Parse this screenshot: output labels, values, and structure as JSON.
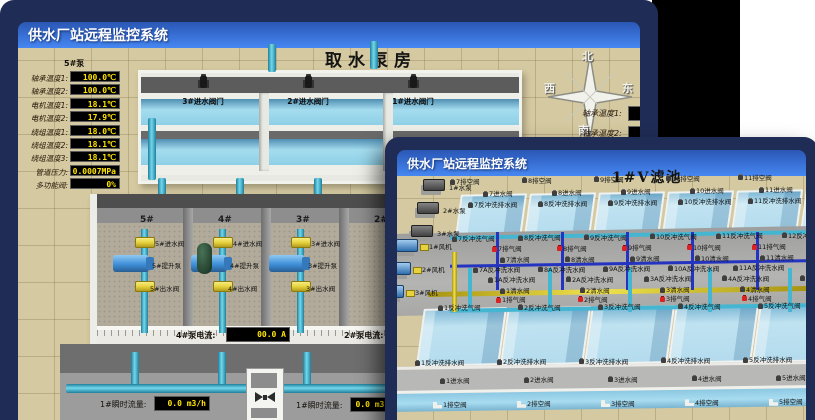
{
  "colors": {
    "frame": "#1f2c55",
    "titlebar_top": "#2a57b5",
    "titlebar_bottom": "#4687f2",
    "floor_tan": "#d4c9a0",
    "led_text": "#ffe400",
    "pipe_cyan": "#45b6d2",
    "valve_yellow": "#e6d23e",
    "pump_blue": "#3f8fd9",
    "water_blue": "#bfe2f0",
    "alarm_red": "#d92222",
    "patch_black": "#000000"
  },
  "back_window": {
    "title": "供水厂站远程监控系统",
    "scene_title": "取水泵房",
    "compass": {
      "n": "北",
      "w": "西",
      "s": "南",
      "e": "东"
    },
    "left_panel": {
      "header": "5#泵",
      "rows": [
        {
          "label": "轴承温度1:",
          "value": "100.0℃"
        },
        {
          "label": "轴承温度2:",
          "value": "100.0℃"
        },
        {
          "label": "电机温度1:",
          "value": "18.1℃"
        },
        {
          "label": "电机温度2:",
          "value": "17.9℃"
        },
        {
          "label": "绕组温度1:",
          "value": "18.0℃"
        },
        {
          "label": "绕组温度2:",
          "value": "18.1℃"
        },
        {
          "label": "绕组温度3:",
          "value": "18.1℃"
        },
        {
          "label": "管道压力:",
          "value": "0.0007MPa"
        },
        {
          "label": "多功能阀:",
          "value": "0%"
        }
      ]
    },
    "right_panel": {
      "rows": [
        "轴承温度1:",
        "轴承温度2:"
      ]
    },
    "intake_valves": [
      "3#进水阀门",
      "2#进水阀门",
      "1#进水阀门"
    ],
    "bay_numbers": [
      "5#",
      "4#",
      "3#",
      "2#"
    ],
    "bays": [
      {
        "inlet": "5#进水阀",
        "pump": "5#提升泵",
        "outlet": "5#出水阀"
      },
      {
        "inlet": "4#进水阀",
        "pump": "4#提升泵",
        "outlet": "4#出水阀"
      },
      {
        "inlet": "3#进水阀",
        "pump": "3#提升泵",
        "outlet": "3#出水阀"
      }
    ],
    "current_left": {
      "label": "4#泵电流:",
      "value": "00.0 A"
    },
    "current_right": {
      "label": "2#泵电流:",
      "value": "00.0 A"
    },
    "flow_left": {
      "label": "1#瞬时流量:",
      "value": "0.0 m3/h"
    },
    "flow_right": {
      "label": "1#瞬时流量:",
      "value": "0.0 m3/h"
    }
  },
  "front_window": {
    "title": "供水厂站远程监控系统",
    "scene_title": "1#V滤池",
    "pumps": [
      "1#水泵",
      "2#水泵",
      "3#水泵"
    ],
    "fans": [
      "1#风机",
      "2#风机",
      "3#风机"
    ],
    "rows": {
      "top_drain": [
        "7排空阀",
        "8排空阀",
        "9排空阀",
        "10排空阀",
        "11排空阀",
        "12排空阀"
      ],
      "top_inlet": [
        "7进水阀",
        "8进水阀",
        "9进水阀",
        "10进水阀",
        "11进水阀"
      ],
      "top_bw_drain": [
        "7反冲洗排水阀",
        "8反冲洗排水阀",
        "9反冲洗排水阀",
        "10反冲洗排水阀",
        "11反冲洗排水阀"
      ],
      "top_bw_air": [
        "7反冲洗气阀",
        "8反冲洗气阀",
        "9反冲洗气阀",
        "10反冲洗气阀",
        "11反冲洗气阀",
        "12反冲洗气阀"
      ],
      "top_air_release": [
        "7排气阀",
        "8排气阀",
        "9排气阀",
        "10排气阀",
        "11排气阀"
      ],
      "top_clean": [
        "7清水阀",
        "8清水阀",
        "9清水阀",
        "10清水阀",
        "11清水阀"
      ],
      "top_bw_water": [
        "7A反冲洗水阀",
        "8A反冲洗水阀",
        "9A反冲洗水阀",
        "10A反冲洗水阀",
        "11A反冲洗水阀"
      ],
      "bot_bw_water": [
        "1A反冲洗水阀",
        "2A反冲洗水阀",
        "3A反冲洗水阀",
        "4A反冲洗水阀",
        "5A反冲洗水阀"
      ],
      "bot_clean": [
        "1清水阀",
        "2清水阀",
        "3清水阀",
        "4清水阀",
        "5清水阀"
      ],
      "bot_air_release": [
        "1排气阀",
        "2排气阀",
        "3排气阀",
        "4排气阀",
        "5排气阀"
      ],
      "bot_bw_air": [
        "1反冲洗气阀",
        "2反冲洗气阀",
        "3反冲洗气阀",
        "4反冲洗气阀",
        "5反冲洗气阀"
      ],
      "bot_bw_drain": [
        "1反冲洗排水阀",
        "2反冲洗排水阀",
        "3反冲洗排水阀",
        "4反冲洗排水阀",
        "5反冲洗排水阀"
      ],
      "bot_inlet": [
        "1进水阀",
        "2进水阀",
        "3进水阀",
        "4进水阀",
        "5进水阀"
      ],
      "bot_drain": [
        "1排空阀",
        "2排空阀",
        "3排空阀",
        "4排空阀",
        "5排空阀"
      ]
    }
  }
}
